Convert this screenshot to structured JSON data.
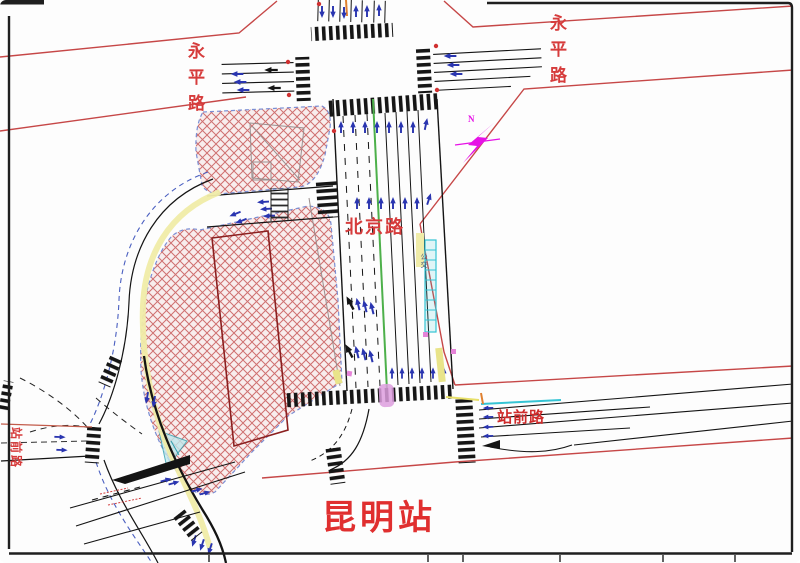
{
  "labels": {
    "yongping_road_west": "永平路",
    "yongping_road_east": "永平路",
    "beijing_road": "北京路",
    "zhanqian_road_east": "站前路",
    "zhanqian_road_west": "站前路",
    "kunming_station": "昆明站",
    "compass_n": "N",
    "bus_lane_marking": "公交"
  },
  "colors": {
    "boundary_red": "#c64747",
    "label_red": "#d63c3c",
    "hatch_line_red": "#cf7070",
    "hatch_fill_pink": "#f8eded",
    "arrow_blue": "#2a35b0",
    "compass_magenta": "#e612e6",
    "lane_marking_yellow": "#f0eca8",
    "lane_line_green": "#4db04a",
    "bus_lane_cyan": "#35c4d4",
    "crossing_marker_pink": "#dd9ede"
  }
}
